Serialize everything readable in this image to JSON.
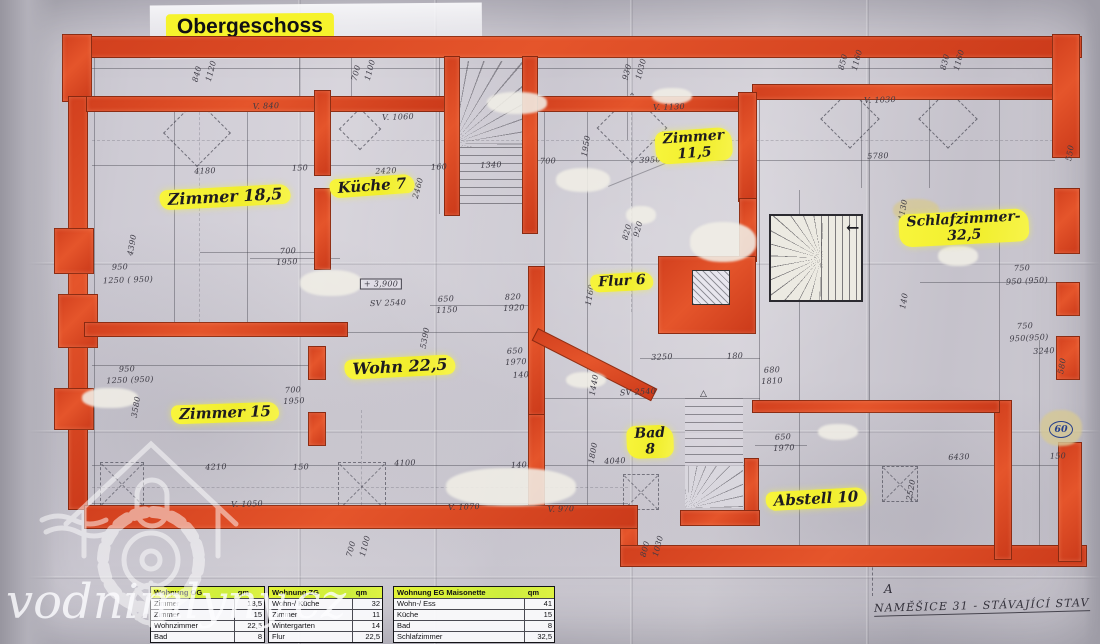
{
  "photo": {
    "title": "Obergeschoss",
    "watermark": "vodnimlyny.cz",
    "caption": "NAMĚŠICE 31 - STÁVAJÍCÍ STAV",
    "section_letter": "A",
    "circled_value": "60",
    "spiral_arrow": "←",
    "stair_mark": "△"
  },
  "colors": {
    "wall_red": "#d6401d",
    "highlight_yellow": "#f6f23a",
    "table_header_green": "#d4ef3a",
    "paper": "#cfccd4",
    "pencil": "#43424c",
    "blue_ink": "#27408b"
  },
  "plan": {
    "rooms": [
      {
        "label": "Zimmer 18,5",
        "x": 225,
        "y": 197,
        "rot": -3,
        "size": 16
      },
      {
        "label": "Küche 7",
        "x": 372,
        "y": 186,
        "rot": -4,
        "size": 15
      },
      {
        "label": "Zimmer\n11,5",
        "x": 694,
        "y": 146,
        "rot": -4,
        "size": 14
      },
      {
        "label": "Schlafzimmer-\n32,5",
        "x": 964,
        "y": 228,
        "rot": -3,
        "size": 14
      },
      {
        "label": "Flur 6",
        "x": 622,
        "y": 282,
        "rot": -3,
        "size": 14
      },
      {
        "label": "Wohn 22,5",
        "x": 400,
        "y": 367,
        "rot": -3,
        "size": 16
      },
      {
        "label": "Zimmer 15",
        "x": 225,
        "y": 413,
        "rot": -2,
        "size": 15
      },
      {
        "label": "Bad\n8",
        "x": 650,
        "y": 442,
        "rot": -2,
        "size": 14
      },
      {
        "label": "Abstell 10",
        "x": 816,
        "y": 499,
        "rot": -3,
        "size": 15
      }
    ],
    "dimensions": [
      {
        "t": "840",
        "x": 197,
        "y": 74,
        "r": -75
      },
      {
        "t": "1120",
        "x": 211,
        "y": 71,
        "r": -75
      },
      {
        "t": "700",
        "x": 356,
        "y": 73,
        "r": -75
      },
      {
        "t": "1100",
        "x": 370,
        "y": 70,
        "r": -75
      },
      {
        "t": "930",
        "x": 627,
        "y": 72,
        "r": -75
      },
      {
        "t": "1030",
        "x": 641,
        "y": 69,
        "r": -75
      },
      {
        "t": "850",
        "x": 843,
        "y": 62,
        "r": -75
      },
      {
        "t": "1160",
        "x": 857,
        "y": 60,
        "r": -75
      },
      {
        "t": "830",
        "x": 945,
        "y": 62,
        "r": -75
      },
      {
        "t": "1160",
        "x": 959,
        "y": 60,
        "r": -75
      },
      {
        "t": "550",
        "x": 1070,
        "y": 153,
        "r": -80
      },
      {
        "t": "V. 840",
        "x": 266,
        "y": 106,
        "r": -2
      },
      {
        "t": "V. 1060",
        "x": 398,
        "y": 117,
        "r": -2
      },
      {
        "t": "V. 1130",
        "x": 669,
        "y": 107,
        "r": -2
      },
      {
        "t": "V. 1030",
        "x": 880,
        "y": 100,
        "r": -2
      },
      {
        "t": "4180",
        "x": 205,
        "y": 171,
        "r": -2
      },
      {
        "t": "150",
        "x": 300,
        "y": 168,
        "r": -2
      },
      {
        "t": "2420",
        "x": 386,
        "y": 171,
        "r": -3
      },
      {
        "t": "160",
        "x": 439,
        "y": 167,
        "r": -3
      },
      {
        "t": "2460",
        "x": 418,
        "y": 188,
        "r": -75
      },
      {
        "t": "1340",
        "x": 491,
        "y": 165,
        "r": -2
      },
      {
        "t": "700",
        "x": 548,
        "y": 161,
        "r": -2
      },
      {
        "t": "1950",
        "x": 586,
        "y": 146,
        "r": -80
      },
      {
        "t": "3950",
        "x": 650,
        "y": 160,
        "r": -2
      },
      {
        "t": "5780",
        "x": 878,
        "y": 156,
        "r": -2
      },
      {
        "t": "4130",
        "x": 903,
        "y": 210,
        "r": -80
      },
      {
        "t": "4390",
        "x": 132,
        "y": 245,
        "r": -80
      },
      {
        "t": "950",
        "x": 120,
        "y": 267,
        "r": -2
      },
      {
        "t": "1250 ( 950)",
        "x": 128,
        "y": 280,
        "r": -2
      },
      {
        "t": "700",
        "x": 288,
        "y": 251,
        "r": -3
      },
      {
        "t": "1950",
        "x": 287,
        "y": 262,
        "r": -3
      },
      {
        "t": "+ 3,900",
        "x": 381,
        "y": 284,
        "r": 0,
        "box": true
      },
      {
        "t": "SV 2540",
        "x": 388,
        "y": 303,
        "r": -2
      },
      {
        "t": "650",
        "x": 446,
        "y": 299,
        "r": -3
      },
      {
        "t": "1150",
        "x": 447,
        "y": 310,
        "r": -3
      },
      {
        "t": "820",
        "x": 513,
        "y": 297,
        "r": -3
      },
      {
        "t": "1920",
        "x": 514,
        "y": 308,
        "r": -3
      },
      {
        "t": "5390",
        "x": 425,
        "y": 338,
        "r": -80
      },
      {
        "t": "1160",
        "x": 590,
        "y": 295,
        "r": -80
      },
      {
        "t": "820",
        "x": 627,
        "y": 232,
        "r": -75
      },
      {
        "t": "920",
        "x": 638,
        "y": 229,
        "r": -75
      },
      {
        "t": "750",
        "x": 1022,
        "y": 268,
        "r": -3
      },
      {
        "t": "950 (950)",
        "x": 1027,
        "y": 281,
        "r": -3
      },
      {
        "t": "140",
        "x": 904,
        "y": 301,
        "r": -80
      },
      {
        "t": "750",
        "x": 1025,
        "y": 326,
        "r": -3
      },
      {
        "t": "950(950)",
        "x": 1029,
        "y": 338,
        "r": -3
      },
      {
        "t": "3240",
        "x": 1044,
        "y": 351,
        "r": -3
      },
      {
        "t": "580",
        "x": 1062,
        "y": 366,
        "r": -80
      },
      {
        "t": "950",
        "x": 127,
        "y": 369,
        "r": -2
      },
      {
        "t": "1250 (950)",
        "x": 130,
        "y": 380,
        "r": -2
      },
      {
        "t": "3580",
        "x": 136,
        "y": 407,
        "r": -80
      },
      {
        "t": "700",
        "x": 293,
        "y": 390,
        "r": -3
      },
      {
        "t": "1950",
        "x": 294,
        "y": 401,
        "r": -3
      },
      {
        "t": "650",
        "x": 515,
        "y": 351,
        "r": -3
      },
      {
        "t": "1970",
        "x": 516,
        "y": 362,
        "r": -3
      },
      {
        "t": "140",
        "x": 521,
        "y": 375,
        "r": -3
      },
      {
        "t": "3250",
        "x": 662,
        "y": 357,
        "r": -3
      },
      {
        "t": "180",
        "x": 735,
        "y": 356,
        "r": -3
      },
      {
        "t": "680",
        "x": 772,
        "y": 370,
        "r": -3
      },
      {
        "t": "1810",
        "x": 772,
        "y": 381,
        "r": -3
      },
      {
        "t": "1440",
        "x": 594,
        "y": 385,
        "r": -80
      },
      {
        "t": "SV 2540",
        "x": 638,
        "y": 392,
        "r": -3
      },
      {
        "t": "1800",
        "x": 593,
        "y": 453,
        "r": -80
      },
      {
        "t": "4040",
        "x": 615,
        "y": 461,
        "r": -3
      },
      {
        "t": "650",
        "x": 783,
        "y": 437,
        "r": -3
      },
      {
        "t": "1970",
        "x": 784,
        "y": 448,
        "r": -3
      },
      {
        "t": "4210",
        "x": 216,
        "y": 467,
        "r": -2
      },
      {
        "t": "150",
        "x": 301,
        "y": 467,
        "r": -2
      },
      {
        "t": "4100",
        "x": 405,
        "y": 463,
        "r": -2
      },
      {
        "t": "140",
        "x": 519,
        "y": 465,
        "r": -2
      },
      {
        "t": "6430",
        "x": 959,
        "y": 457,
        "r": -2
      },
      {
        "t": "150",
        "x": 1058,
        "y": 456,
        "r": -2
      },
      {
        "t": "2520",
        "x": 911,
        "y": 490,
        "r": -80
      },
      {
        "t": "V. 1050",
        "x": 247,
        "y": 504,
        "r": -2
      },
      {
        "t": "V. 1070",
        "x": 464,
        "y": 507,
        "r": -2
      },
      {
        "t": "V. 970",
        "x": 561,
        "y": 509,
        "r": -2
      },
      {
        "t": "700",
        "x": 351,
        "y": 549,
        "r": -75
      },
      {
        "t": "1100",
        "x": 365,
        "y": 546,
        "r": -75
      },
      {
        "t": "800",
        "x": 645,
        "y": 549,
        "r": -75
      },
      {
        "t": "1030",
        "x": 658,
        "y": 546,
        "r": -75
      }
    ]
  },
  "tables": [
    {
      "title": "Wohnung OG",
      "unit": "qm",
      "rows": [
        [
          "Zimmer",
          "18,5"
        ],
        [
          "Zimmer",
          "15"
        ],
        [
          "Wohnzimmer",
          "22,5"
        ],
        [
          "Bad",
          "8"
        ]
      ]
    },
    {
      "title": "Wohnung ZG",
      "unit": "qm",
      "rows": [
        [
          "Wohn-/ Küche",
          "32"
        ],
        [
          "Zimmer",
          "11"
        ],
        [
          "Wintergarten",
          "14"
        ],
        [
          "Flur",
          "22,5"
        ]
      ]
    },
    {
      "title": "Wohnung EG Maisonette",
      "unit": "qm",
      "rows": [
        [
          "Wohn-/ Ess",
          "41"
        ],
        [
          "Küche",
          "15"
        ],
        [
          "Bad",
          "8"
        ],
        [
          "Schlafzimmer",
          "32,5"
        ]
      ]
    }
  ]
}
